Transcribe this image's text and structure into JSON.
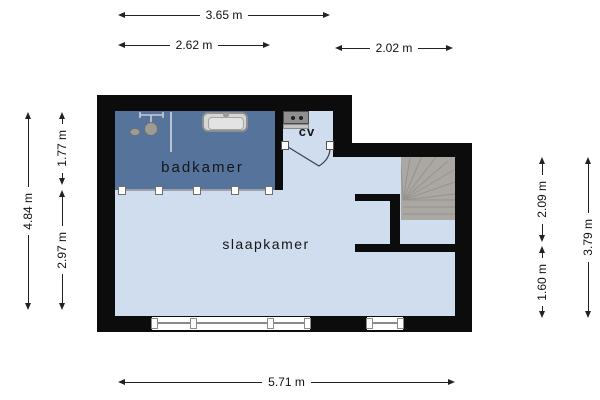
{
  "floorplan": {
    "rooms": {
      "bathroom": "badkamer",
      "bedroom": "slaapkamer",
      "boiler_closet": "cv"
    },
    "dimensions": {
      "top_total": "3.65 m",
      "top_left": "2.62 m",
      "top_right": "2.02 m",
      "left_total": "4.84 m",
      "left_upper": "1.77 m",
      "left_lower": "2.97 m",
      "right_upper": "2.09 m",
      "right_lower": "1.60 m",
      "right_total": "3.79 m",
      "bottom_total": "5.71 m"
    },
    "colors": {
      "wall": "#0c0c0c",
      "bathroom_floor": "#55739b",
      "bedroom_floor": "#cfddee",
      "stairs": "#aba7a2",
      "dimension_text": "#111111",
      "background": "#ffffff"
    }
  }
}
